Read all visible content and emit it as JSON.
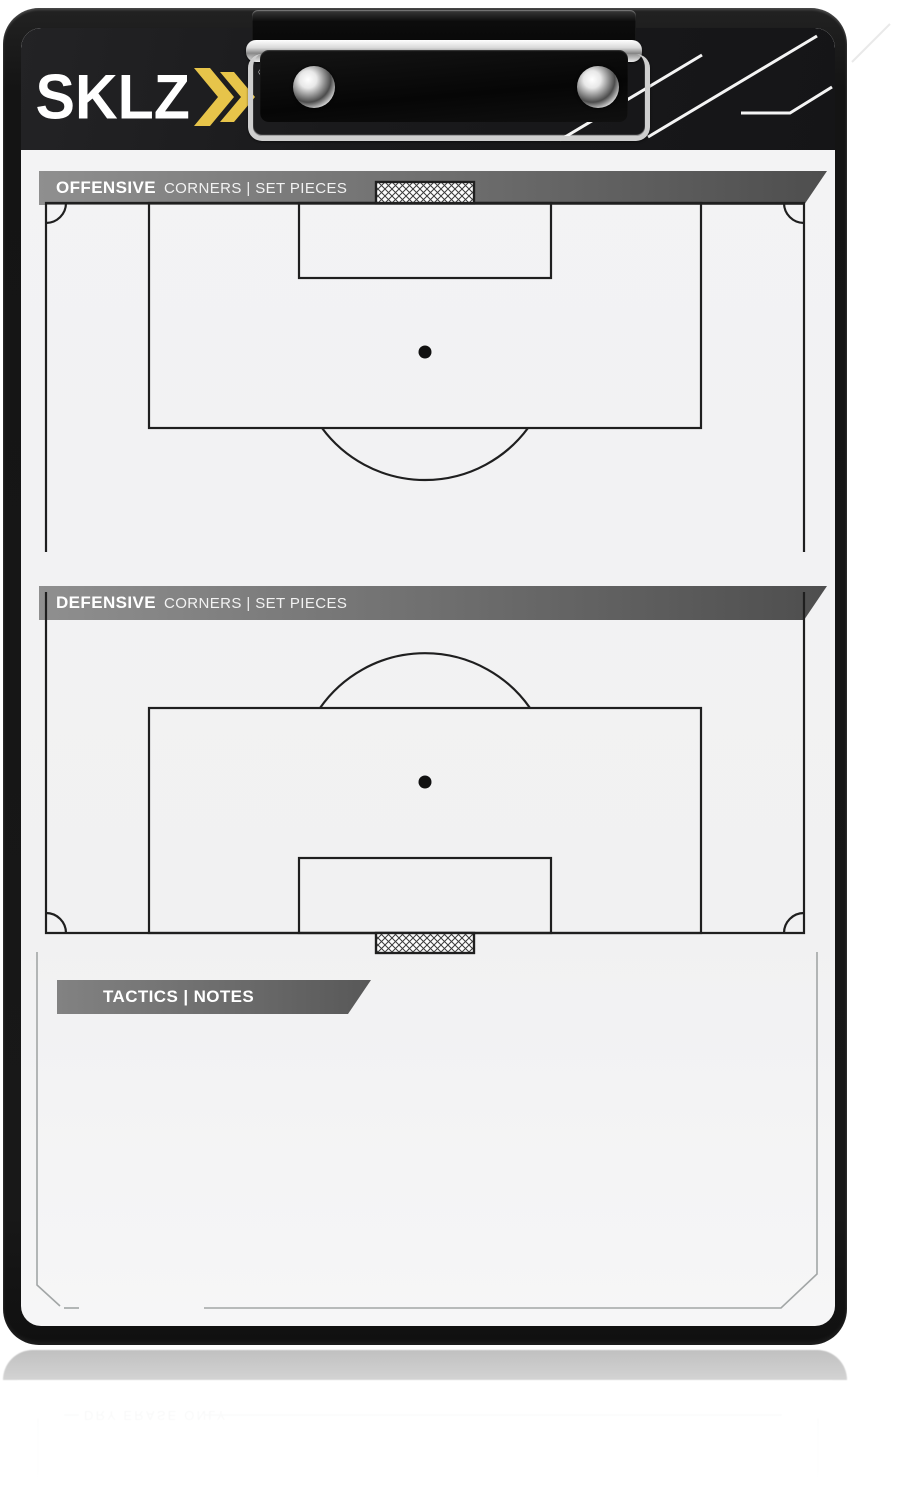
{
  "product": {
    "brand": "SKLZ",
    "registered_mark": "®",
    "banners": [
      {
        "bold": "OFFENSIVE",
        "rest": "CORNERS | SET PIECES"
      },
      {
        "bold": "DEFENSIVE",
        "rest": "CORNERS | SET PIECES"
      },
      {
        "bold": "TACTICS | NOTES",
        "rest": ""
      }
    ],
    "footer_note": "DRY ERASE ONLY",
    "colors": {
      "accent_gold": "#e7c44a",
      "frame_black": "#161616",
      "header_black": "#1a1a1c",
      "banner_gray_left": "#8f8f8f",
      "banner_gray_right": "#4e4e4e",
      "surface_white": "#f2f2f3",
      "field_line": "#1f1f1f",
      "footer_text_gray": "#8e9494"
    }
  }
}
